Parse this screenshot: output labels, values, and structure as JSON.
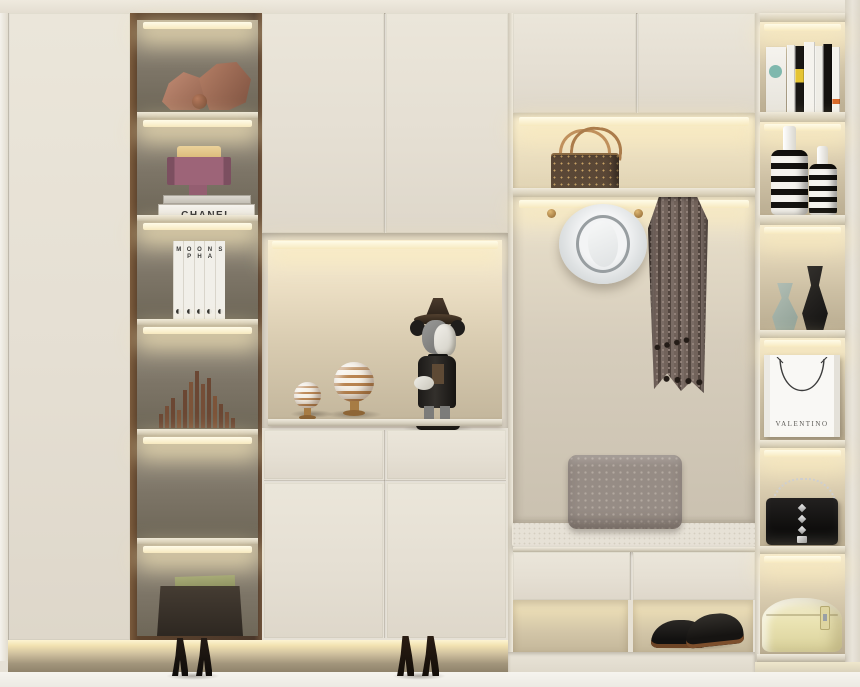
{
  "labels": {
    "chanel_thin": "CHANEL THE VOCABULARY OF STYLE",
    "chanel_thick": "CHANEL",
    "valentino": "VALENTINO"
  },
  "moon_books": {
    "title_hint": "MOON PHASES book set",
    "spines": [
      {
        "top": "M",
        "bottom": ""
      },
      {
        "top": "O",
        "bottom": "P"
      },
      {
        "top": "O",
        "bottom": "H"
      },
      {
        "top": "N",
        "bottom": "A"
      },
      {
        "top": "",
        "bottom": "S"
      }
    ]
  },
  "inventory": {
    "left_glass_column": [
      "faceted stone sculptures",
      "geometric purse sculpture on CHANEL books",
      "moon phases book set",
      "wooden skyline sculpture",
      "empty lit shelf",
      "storage basket with folders"
    ],
    "middle_niche": [
      "two striped orb ornaments on brass stands",
      "toy figurine with hat covering face"
    ],
    "hall_niche": [
      "monogram handbag on lit shelf",
      "brass wall hooks",
      "white fedora hat",
      "pompom fringe scarf",
      "grey patterned pillow",
      "bench seat cushion",
      "pair of black dress shoes in lit cubby"
    ],
    "right_open_column": [
      "row of books",
      "two striped vases",
      "sage and black sculptural vases",
      "VALENTINO paper bag",
      "black studded chain clutch",
      "round cream hat box"
    ],
    "floor": [
      "two pairs of black high heels",
      "LED toe-kick lighting"
    ]
  },
  "colors": {
    "cabinet_cream": "#e6e1d6",
    "bronze_frame": "#6e523a",
    "led_warm": "#fdf3d0",
    "glass_interior": "#7d7567",
    "niche_back": "#d8cdb4",
    "floor": "#f3f1ec",
    "figurine_dark": "#23211f",
    "scarf_taupe": "#72635b",
    "pillow_grey": "#968c85",
    "hat_white": "#eef0f1",
    "hatbox_yellow": "#e9e2b0",
    "sage_vase": "#a8b4aa",
    "monogram_brown": "#5a4736",
    "strap_tan": "#c0905c"
  }
}
